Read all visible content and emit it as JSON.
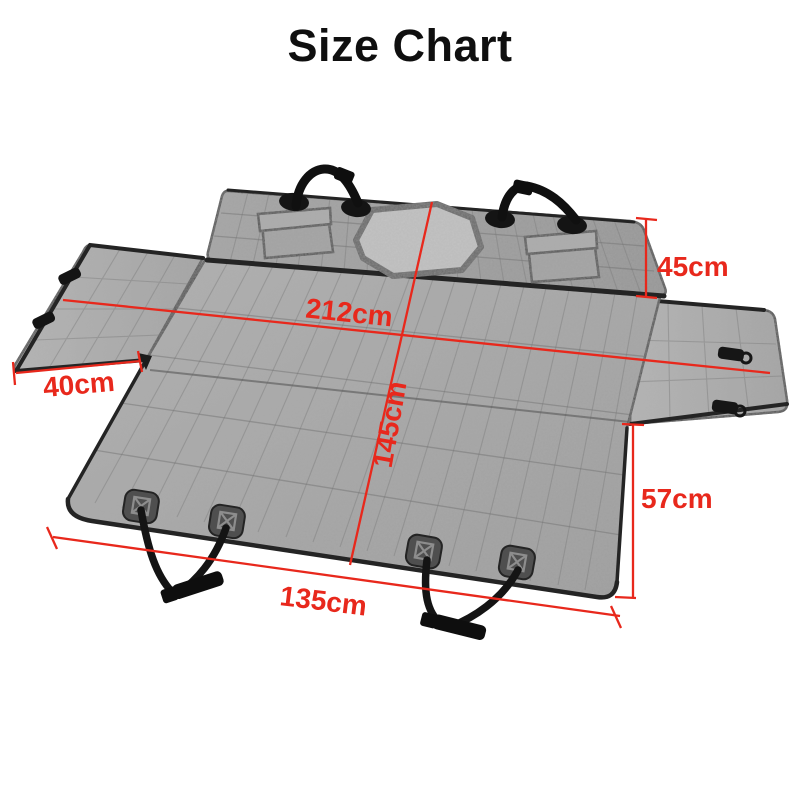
{
  "title": "Size Chart",
  "colors": {
    "background": "#ffffff",
    "title_text": "#0f0f0f",
    "dimension_red": "#e8281c",
    "fabric_gray": "#a6a6a6",
    "fabric_trim_dark": "#262626",
    "mesh_window_gray": "#c7c7c7",
    "strap_black": "#161616"
  },
  "dimensions": {
    "top_width": "212cm",
    "center_height": "145cm",
    "backrest_side_height": "45cm",
    "side_flap_width": "40cm",
    "rear_drop_height": "57cm",
    "bottom_width": "135cm"
  }
}
